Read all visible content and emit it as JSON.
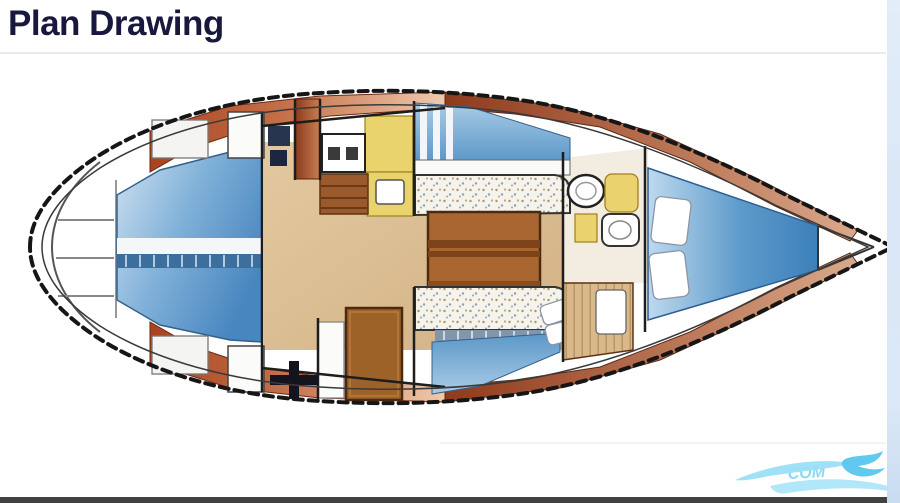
{
  "page": {
    "title": "Plan Drawing"
  },
  "theme": {
    "title_color": "#18183f",
    "divider_color": "#ebebeb",
    "bottom_bar_color": "#414141",
    "right_edge_color": "#dbe8f7",
    "background": "#ffffff"
  },
  "plan": {
    "type": "sailboat-interior-top-view",
    "orientation": "bow-right-stern-left",
    "regions": [
      {
        "name": "hull-outline",
        "color": "#161616",
        "style": "dashed"
      },
      {
        "name": "swim-platform-steps",
        "color": "#f5f5f5"
      },
      {
        "name": "aft-cabin-berth",
        "color": "#4886bf"
      },
      {
        "name": "side-deck-aft",
        "color": "#a8431f"
      },
      {
        "name": "side-deck-bow-band",
        "color": "#8f3a1c"
      },
      {
        "name": "companionway-hatch",
        "color": "#8a3a1c"
      },
      {
        "name": "nav-station",
        "color": "#27354f"
      },
      {
        "name": "galley-stove",
        "color": "#ffffff"
      },
      {
        "name": "galley-counter",
        "color": "#e9d36c"
      },
      {
        "name": "galley-sink",
        "color": "#ffffff"
      },
      {
        "name": "companionway-steps",
        "color": "#9a5a2c"
      },
      {
        "name": "salon-floor",
        "color": "#dcc097"
      },
      {
        "name": "salon-table",
        "color": "#aa6630"
      },
      {
        "name": "starboard-settee",
        "color": "#f4f1e8"
      },
      {
        "name": "port-settee",
        "color": "#f4f1e8"
      },
      {
        "name": "settee-backrest",
        "color": "#5b97c8"
      },
      {
        "name": "wardrobe-door",
        "color": "#9c6228"
      },
      {
        "name": "head-sink",
        "color": "#ffffff"
      },
      {
        "name": "head-seat",
        "color": "#ead36e"
      },
      {
        "name": "head-toilet",
        "color": "#ffffff"
      },
      {
        "name": "bow-lockers",
        "color": "#d9b98c"
      },
      {
        "name": "v-berth",
        "color": "#3c80ba"
      },
      {
        "name": "v-berth-pillows",
        "color": "#ffffff"
      },
      {
        "name": "mast-symbol",
        "color": "#14141e"
      }
    ]
  },
  "watermark": {
    "text": "COM",
    "color": "#7fd4f0"
  }
}
